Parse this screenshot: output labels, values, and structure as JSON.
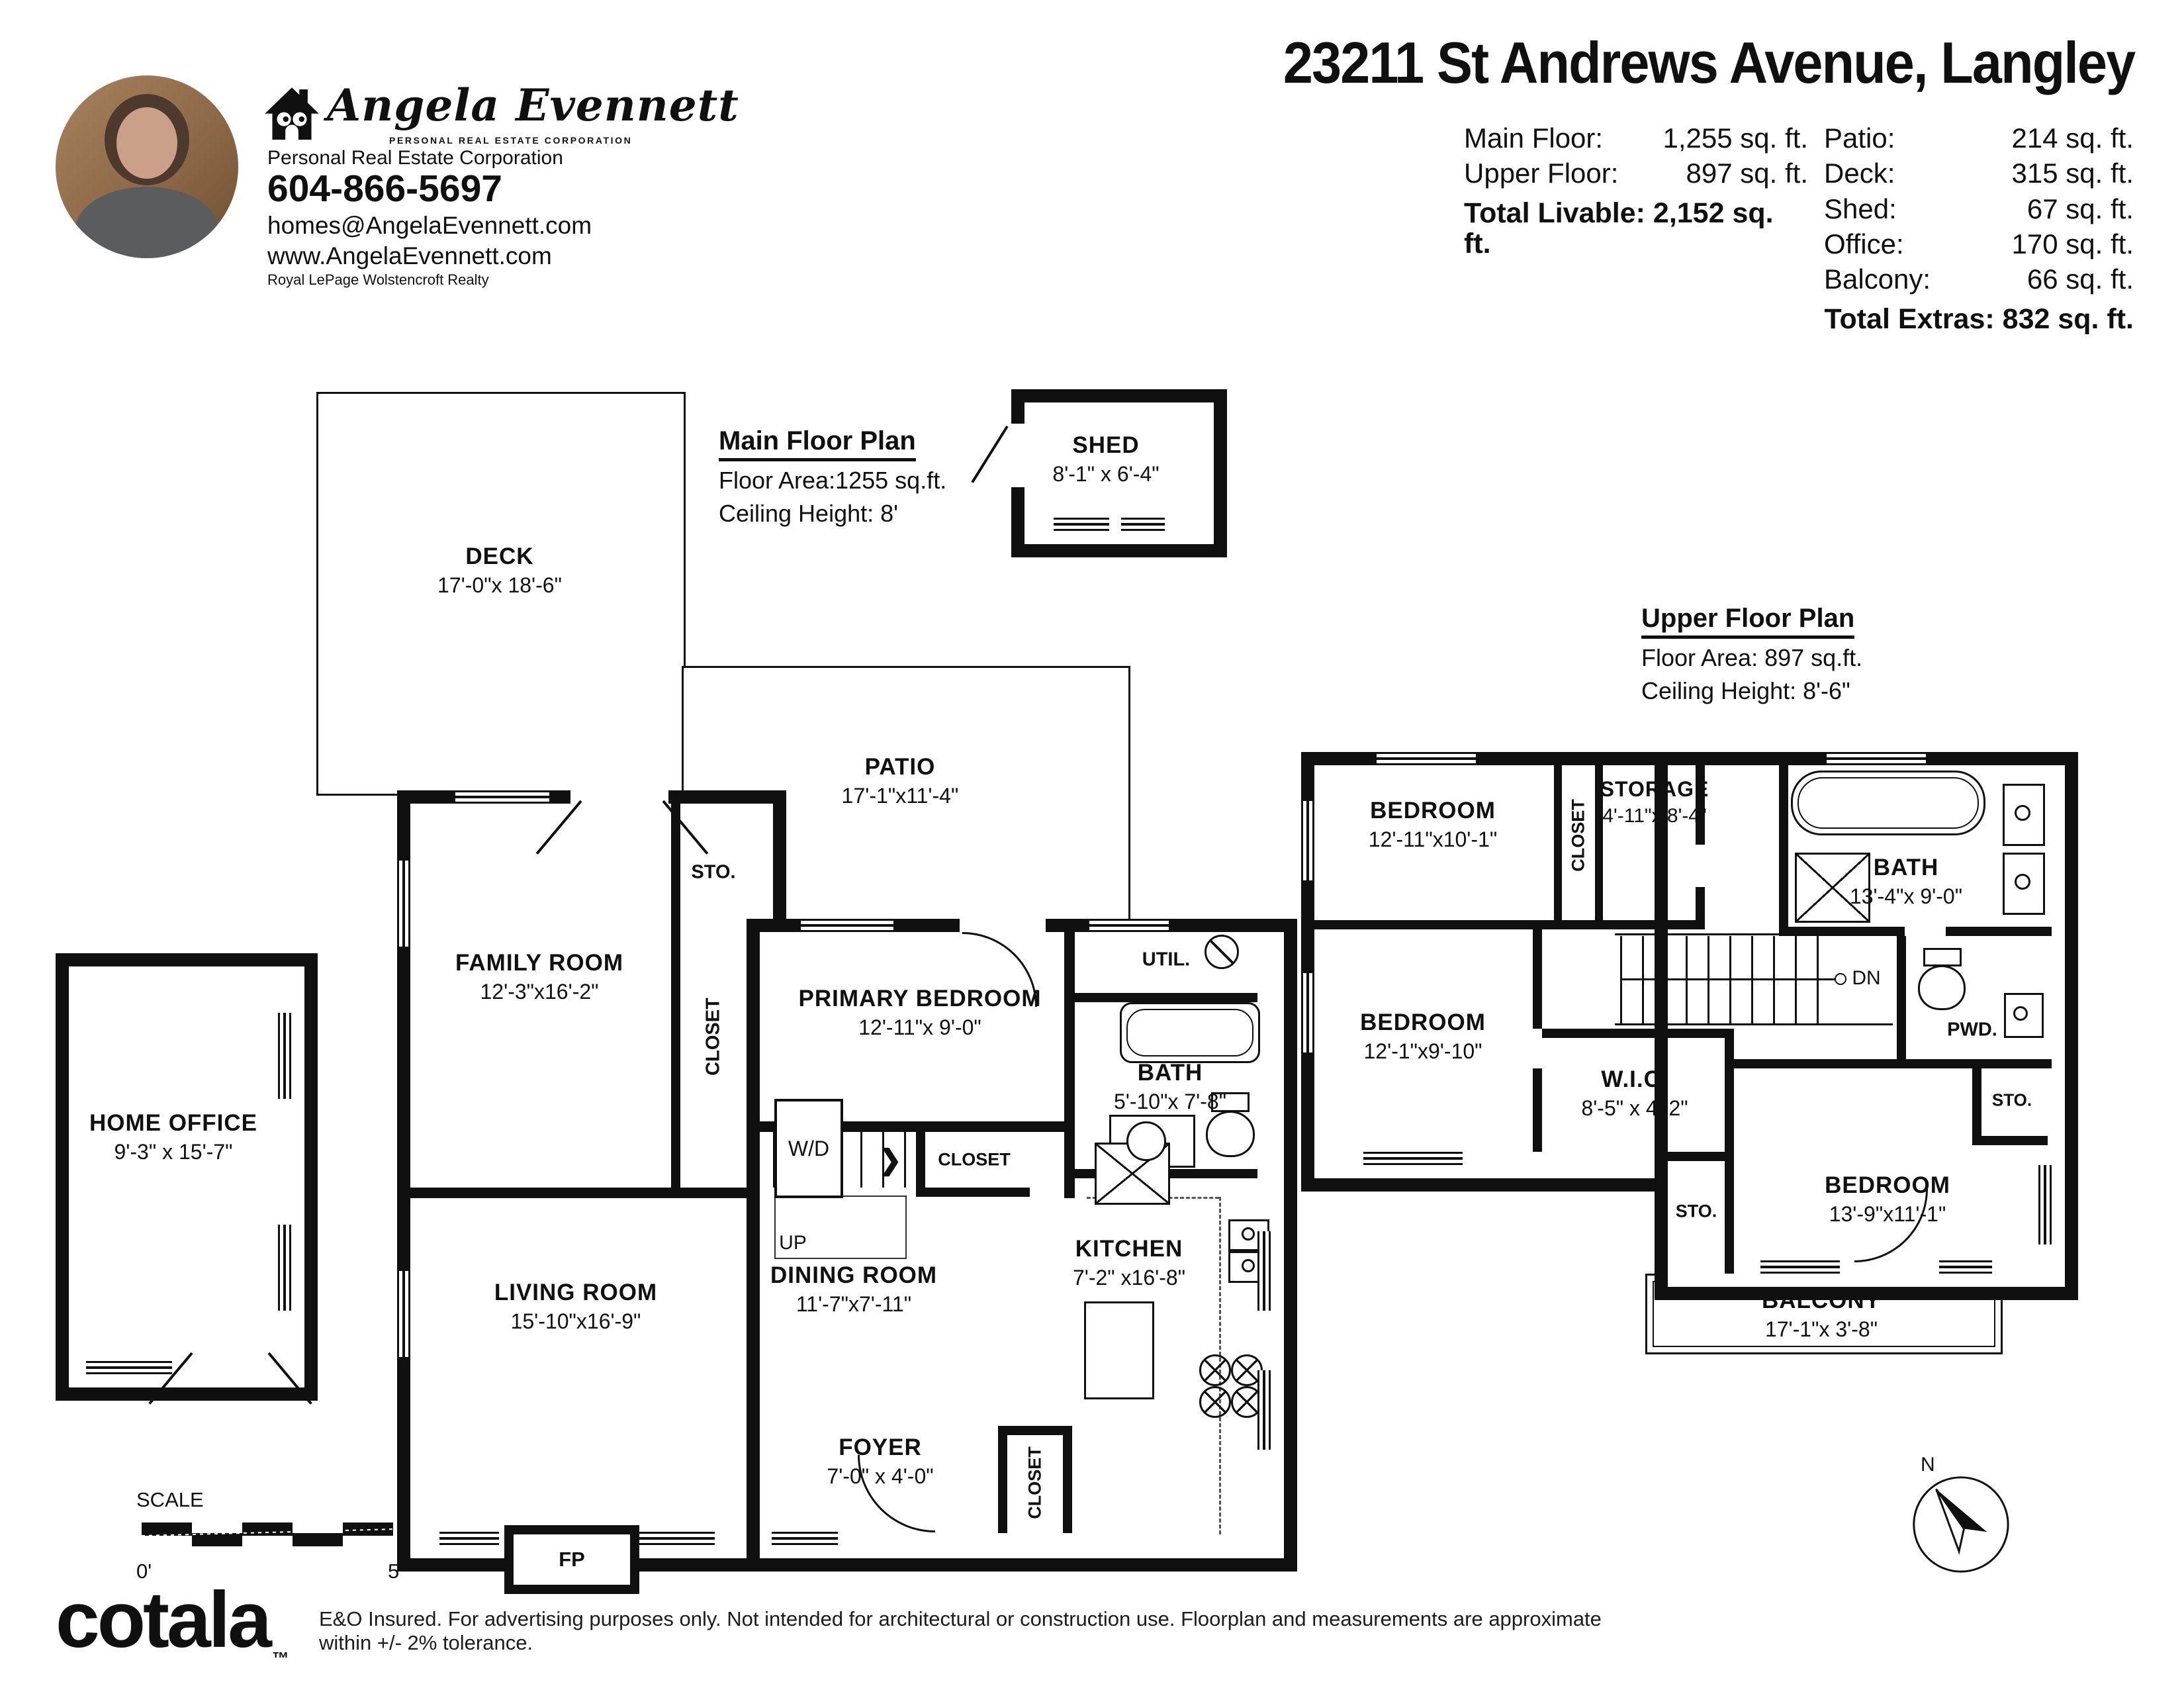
{
  "header": {
    "brand": {
      "script_name": "Angela Evennett",
      "tagline": "PERSONAL REAL ESTATE CORPORATION"
    },
    "agent": {
      "designation": "Personal Real Estate Corporation",
      "phone": "604-866-5697",
      "email": "homes@AngelaEvennett.com",
      "website": "www.AngelaEvennett.com",
      "brokerage": "Royal LePage Wolstencroft Realty"
    },
    "title": "23211 St Andrews Avenue, Langley",
    "areas_left": [
      {
        "label": "Main Floor:",
        "value": "1,255 sq. ft."
      },
      {
        "label": "Upper Floor:",
        "value": "897 sq. ft."
      }
    ],
    "total_livable": "Total Livable: 2,152 sq. ft.",
    "areas_right": [
      {
        "label": "Patio:",
        "value": "214 sq. ft."
      },
      {
        "label": "Deck:",
        "value": "315 sq. ft."
      },
      {
        "label": "Shed:",
        "value": "67 sq. ft."
      },
      {
        "label": "Office:",
        "value": "170 sq. ft."
      },
      {
        "label": "Balcony:",
        "value": "66 sq. ft."
      }
    ],
    "total_extras": "Total Extras: 832 sq. ft."
  },
  "main_floor": {
    "plan_title": "Main Floor Plan",
    "floor_area": "Floor Area:1255 sq.ft.",
    "ceiling_height": "Ceiling Height: 8'",
    "rooms": {
      "deck": {
        "name": "DECK",
        "dims": "17'-0\"x 18'-6\""
      },
      "shed": {
        "name": "SHED",
        "dims": "8'-1\" x 6'-4\""
      },
      "patio": {
        "name": "PATIO",
        "dims": "17'-1\"x11'-4\""
      },
      "family_room": {
        "name": "FAMILY ROOM",
        "dims": "12'-3\"x16'-2\""
      },
      "storage": "STO.",
      "hall_closet": "CLOSET",
      "primary_bedroom": {
        "name": "PRIMARY BEDROOM",
        "dims": "12'-11\"x 9'-0\""
      },
      "utility": "UTIL.",
      "bath": {
        "name": "BATH",
        "dims": "5'-10\"x 7'-8\""
      },
      "washer_dryer": "W/D",
      "stairs_closet": "CLOSET",
      "stairs_up": "UP",
      "living_room": {
        "name": "LIVING ROOM",
        "dims": "15'-10\"x16'-9\""
      },
      "dining_room": {
        "name": "DINING ROOM",
        "dims": "11'-7\"x7'-11\""
      },
      "kitchen": {
        "name": "KITCHEN",
        "dims": "7'-2\" x16'-8\""
      },
      "foyer": {
        "name": "FOYER",
        "dims": "7'-0\" x 4'-0\""
      },
      "foyer_closet": "CLOSET",
      "fireplace": "FP",
      "home_office": {
        "name": "HOME OFFICE",
        "dims": "9'-3\" x 15'-7\""
      }
    }
  },
  "upper_floor": {
    "plan_title": "Upper Floor Plan",
    "floor_area": "Floor Area: 897 sq.ft.",
    "ceiling_height": "Ceiling Height: 8'-6\"",
    "rooms": {
      "bedroom1": {
        "name": "BEDROOM",
        "dims": "12'-11\"x10'-1\""
      },
      "closet": "CLOSET",
      "storage": {
        "name": "STORAGE",
        "dims": "4'-11\"x 8'-4\""
      },
      "bath": {
        "name": "BATH",
        "dims": "13'-4\"x 9'-0\""
      },
      "stairs_dn": "DN",
      "powder": "PWD.",
      "bedroom2": {
        "name": "BEDROOM",
        "dims": "12'-1\"x9'-10\""
      },
      "wic": {
        "name": "W.I.C.",
        "dims": "8'-5\" x 4'-2\""
      },
      "storage_left": "STO.",
      "bedroom3": {
        "name": "BEDROOM",
        "dims": "13'-9\"x11'-1\""
      },
      "storage_right": "STO.",
      "balcony": {
        "name": "BALCONY",
        "dims": "17'-1\"x 3'-8\""
      }
    }
  },
  "footer": {
    "scale_label": "SCALE",
    "scale_start": "0'",
    "scale_end": "5'",
    "logo": "cotala",
    "logo_tm": "™",
    "disclaimer": "E&O Insured. For advertising purposes only. Not intended for architectural or construction use. Floorplan and measurements are approximate within +/- 2% tolerance.",
    "compass_n": "N"
  }
}
